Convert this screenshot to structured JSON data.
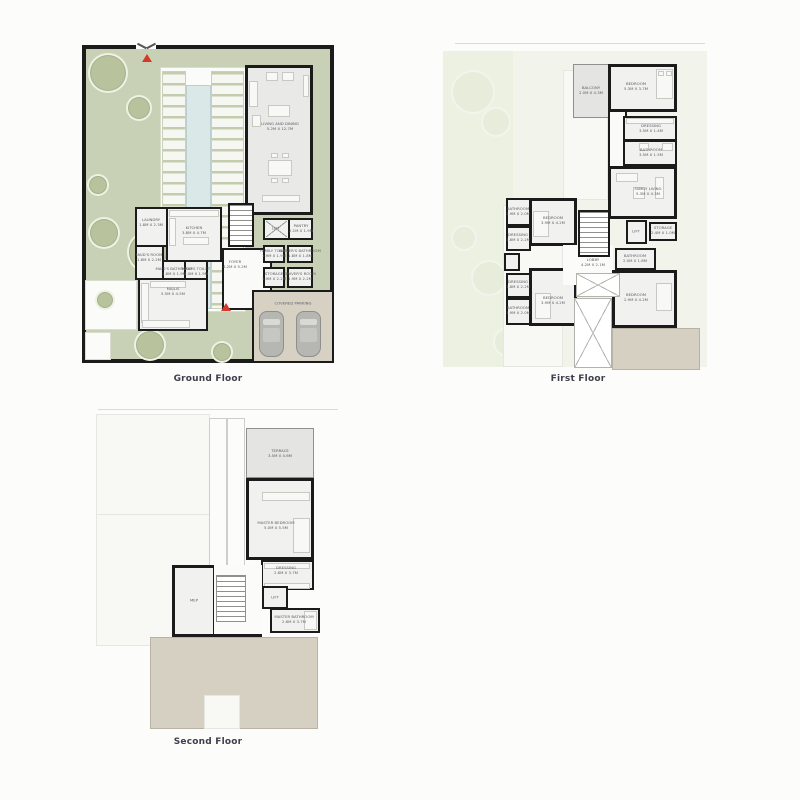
{
  "colors": {
    "garden_green": "#c8d1b5",
    "wall_black": "#1b1b1b",
    "pool_blue": "#dbe8e8",
    "terrace_beige": "#d7d1c4",
    "marker_red": "#d5392b",
    "caption_text": "#3f3f4c"
  },
  "plans": {
    "ground": {
      "caption": "Ground Floor",
      "rooms": {
        "living_dining": {
          "name": "LIVING AND DINING",
          "dims": "5.2M X 12.7M"
        },
        "laundry": {
          "name": "LAUNDRY",
          "dims": "1.8M X 2.3M"
        },
        "kitchen": {
          "name": "KITCHEN",
          "dims": "3.8M X 4.7M"
        },
        "maids_room": {
          "name": "MAID'S ROOM",
          "dims": "1.8M X 2.2M"
        },
        "maids_bathroom": {
          "name": "MAID'S BATHROOM",
          "dims": "1.8M X 1.9M"
        },
        "maids_toilet": {
          "name": "MAID'S TOILET",
          "dims": "1.0M X 1.9M"
        },
        "majlis": {
          "name": "MAJLIS",
          "dims": "5.5M X 4.5M"
        },
        "foyer": {
          "name": "FOYER",
          "dims": "4.2M X 5.2M"
        },
        "lift": {
          "name": "LIFT",
          "dims": ""
        },
        "pantry": {
          "name": "PANTRY",
          "dims": "2.1M X 1.9M"
        },
        "family_toilet": {
          "name": "FAMILY TOILET",
          "dims": "1.9M X 1.9M"
        },
        "drivers_bathroom": {
          "name": "DRIVER'S BATHROOM",
          "dims": "1.8M X 1.8M"
        },
        "storage": {
          "name": "STORAGE",
          "dims": "1.9M X 2.2M"
        },
        "drivers_room": {
          "name": "DRIVER'S ROOM",
          "dims": "1.9M X 2.2M"
        },
        "parking": {
          "name": "COVERED PARKING",
          "dims": ""
        }
      }
    },
    "first": {
      "caption": "First Floor",
      "rooms": {
        "balcony": {
          "name": "BALCONY",
          "dims": "2.0M X 4.3M"
        },
        "bedroom_top": {
          "name": "BEDROOM",
          "dims": "5.3M X 3.7M"
        },
        "dressing_top": {
          "name": "DRESSING",
          "dims": "3.5M X 1.4M"
        },
        "bathroom_top": {
          "name": "BATHROOM",
          "dims": "3.5M X 1.5M"
        },
        "family_living": {
          "name": "FAMILY LIVING",
          "dims": "5.3M X 4.3M"
        },
        "bedroom_left_top": {
          "name": "BEDROOM",
          "dims": "3.9M X 4.2M"
        },
        "bathroom_left_top": {
          "name": "BATHROOM",
          "dims": "1.9M X 2.0M"
        },
        "dressing_left_top": {
          "name": "DRESSING",
          "dims": "1.8M X 2.2M"
        },
        "dressing_left_bottom": {
          "name": "DRESSING",
          "dims": "1.8M X 2.2M"
        },
        "bathroom_left_bottom": {
          "name": "BATHROOM",
          "dims": "1.9M X 2.0M"
        },
        "bedroom_left_bottom": {
          "name": "BEDROOM",
          "dims": "3.9M X 4.2M"
        },
        "lobby": {
          "name": "LOBBY",
          "dims": "4.2M X 2.1M"
        },
        "lift": {
          "name": "LIFT",
          "dims": ""
        },
        "storage": {
          "name": "STORAGE",
          "dims": "2.4M X 1.0M"
        },
        "bathroom_right": {
          "name": "BATHROOM",
          "dims": "2.0M X 1.8M"
        },
        "bedroom_right": {
          "name": "BEDROOM",
          "dims": "2.9M X 4.2M"
        }
      }
    },
    "second": {
      "caption": "Second Floor",
      "rooms": {
        "terrace": {
          "name": "TERRACE",
          "dims": "3.5M X 4.6M"
        },
        "master_bedroom": {
          "name": "MASTER BEDROOM",
          "dims": "5.0M X 5.5M"
        },
        "dressing": {
          "name": "DRESSING",
          "dims": "2.8M X 3.7M"
        },
        "lift": {
          "name": "LIFT",
          "dims": ""
        },
        "master_bathroom": {
          "name": "MASTER BATHROOM",
          "dims": "2.8M X 3.7M"
        },
        "mep": {
          "name": "MEP",
          "dims": ""
        }
      }
    }
  }
}
